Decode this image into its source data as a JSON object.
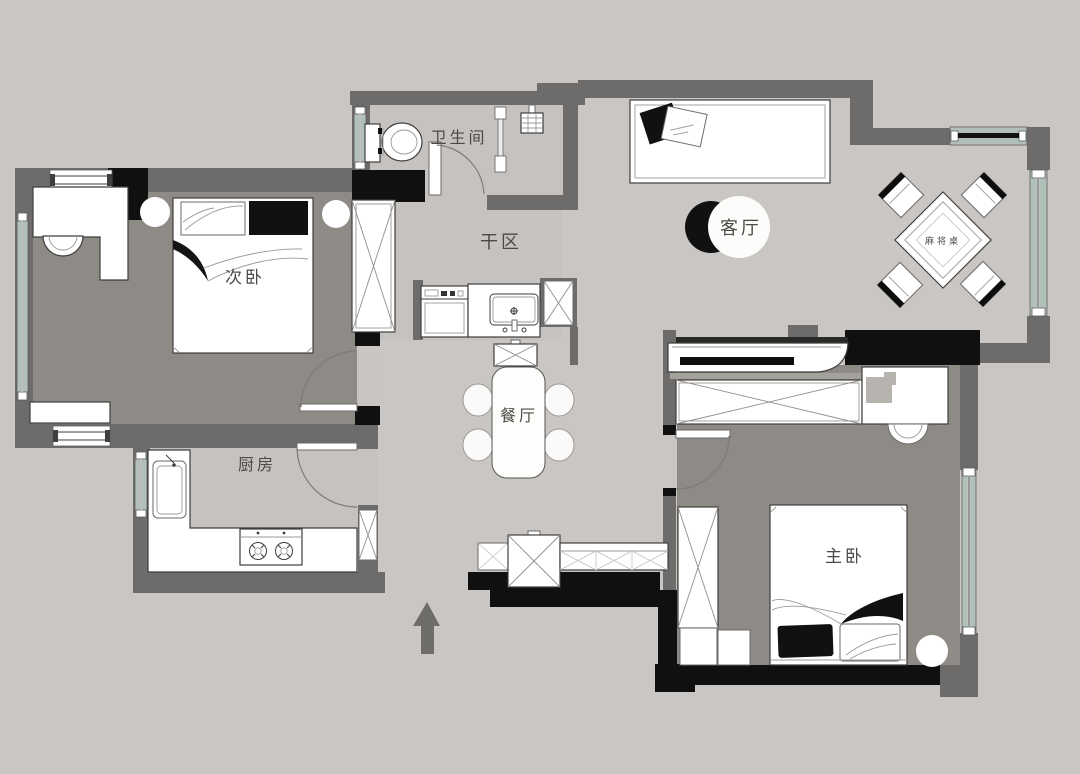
{
  "diagram": {
    "type": "apartment-floor-plan",
    "orientation_marker": "north-arrow"
  },
  "rooms": {
    "secondary_bedroom": {
      "label": "次卧"
    },
    "kitchen": {
      "label": "厨房"
    },
    "bathroom": {
      "label": "卫生间"
    },
    "dry_area": {
      "label": "干区"
    },
    "dining_room": {
      "label": "餐厅"
    },
    "living_room": {
      "label": "客厅"
    },
    "master_bedroom": {
      "label": "主卧"
    },
    "mahjong_area": {
      "label": "麻将桌"
    }
  },
  "colors": {
    "background": "#cac6c3",
    "wall": "#6d6c6a",
    "wall_accent": "#101010",
    "bedroom_floor": "#8e8a85",
    "wet_area_floor": "#c6c2bf",
    "window_glass": "#b2c0ba",
    "furniture": "#ffffff",
    "label_text": "#4b4a47"
  }
}
